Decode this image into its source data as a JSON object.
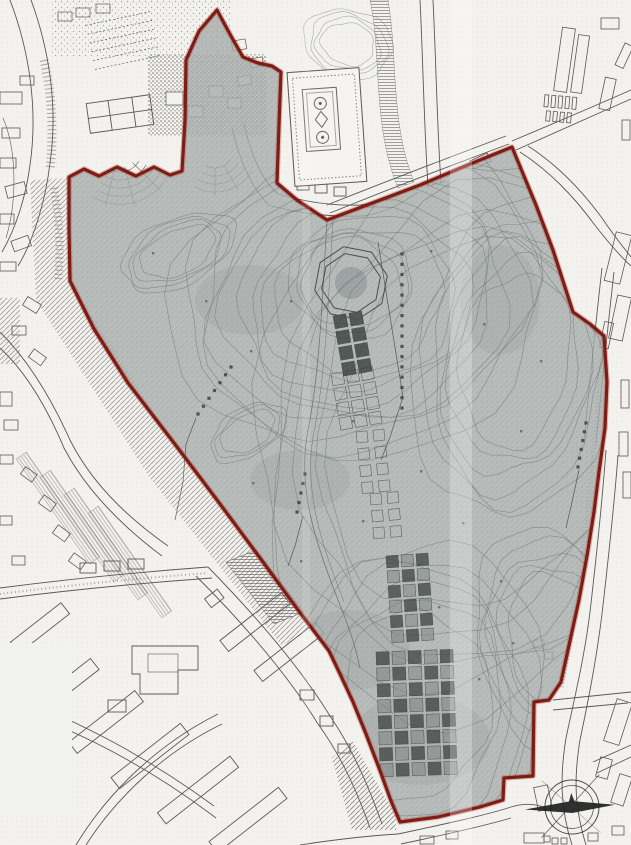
{
  "document": {
    "kind": "scanned site plan map",
    "visible_text": [],
    "notes": "monochrome scanned survey map with shaded study area outlined in dark red; annotation micro-text on map is illegible"
  },
  "map": {
    "palette": {
      "paper": "#f3f2ee",
      "ink": "#3f3e3c",
      "site_fill": "#a9aeac",
      "site_texture": "#7e8481",
      "contour": "#68706d",
      "boundary_red": "#7b150e",
      "boundary_red_soft": "#a03522",
      "structure_dark": "#3d4242",
      "structure_mid": "#7c8282",
      "needle_dark": "#1f1f1f"
    },
    "boundary": {
      "points": [
        [
          217,
          10
        ],
        [
          231,
          36
        ],
        [
          243,
          57
        ],
        [
          258,
          63
        ],
        [
          272,
          66
        ],
        [
          281,
          72
        ],
        [
          279,
          125
        ],
        [
          277,
          183
        ],
        [
          297,
          200
        ],
        [
          327,
          220
        ],
        [
          420,
          185
        ],
        [
          470,
          164
        ],
        [
          512,
          147
        ],
        [
          536,
          205
        ],
        [
          553,
          250
        ],
        [
          564,
          284
        ],
        [
          573,
          312
        ],
        [
          590,
          324
        ],
        [
          604,
          336
        ],
        [
          607,
          382
        ],
        [
          605,
          428
        ],
        [
          599,
          472
        ],
        [
          594,
          512
        ],
        [
          587,
          556
        ],
        [
          579,
          600
        ],
        [
          568,
          650
        ],
        [
          561,
          682
        ],
        [
          549,
          700
        ],
        [
          534,
          702
        ],
        [
          533,
          776
        ],
        [
          504,
          778
        ],
        [
          503,
          800
        ],
        [
          480,
          807
        ],
        [
          438,
          817
        ],
        [
          400,
          822
        ],
        [
          391,
          801
        ],
        [
          379,
          768
        ],
        [
          366,
          734
        ],
        [
          353,
          702
        ],
        [
          340,
          674
        ],
        [
          329,
          651
        ],
        [
          298,
          610
        ],
        [
          260,
          558
        ],
        [
          217,
          500
        ],
        [
          174,
          443
        ],
        [
          128,
          383
        ],
        [
          94,
          329
        ],
        [
          70,
          281
        ],
        [
          69,
          229
        ],
        [
          69,
          177
        ],
        [
          84,
          169
        ],
        [
          99,
          176
        ],
        [
          117,
          167
        ],
        [
          136,
          176
        ],
        [
          154,
          167
        ],
        [
          170,
          175
        ],
        [
          182,
          171
        ],
        [
          185,
          120
        ],
        [
          186,
          60
        ],
        [
          199,
          31
        ]
      ]
    },
    "octagon": {
      "cx": 351,
      "cy": 283,
      "radii": [
        37,
        30
      ],
      "rot": 11,
      "smudge_radius": 16
    },
    "grids": [
      {
        "name": "checker-upper",
        "x": 333,
        "y": 316,
        "cols": 2,
        "rows": 4,
        "cell": 13,
        "gap": 3,
        "rot": -10,
        "style": "dark"
      },
      {
        "name": "checker-upper-faint",
        "x": 331,
        "y": 374,
        "cols": 3,
        "rows": 4,
        "cell": 12,
        "gap": 3,
        "rot": -10,
        "style": "faint"
      },
      {
        "name": "checker-trail-a",
        "x": 356,
        "y": 432,
        "cols": 2,
        "rows": 4,
        "cell": 11,
        "gap": 6,
        "rot": -6,
        "style": "faint"
      },
      {
        "name": "checker-trail-b",
        "x": 370,
        "y": 494,
        "cols": 2,
        "rows": 3,
        "cell": 11,
        "gap": 6,
        "rot": -5,
        "style": "faint"
      },
      {
        "name": "checker-mid",
        "x": 386,
        "y": 556,
        "cols": 3,
        "rows": 6,
        "cell": 12,
        "gap": 3,
        "rot": -4,
        "style": "mixed"
      },
      {
        "name": "checker-lower",
        "x": 376,
        "y": 652,
        "cols": 5,
        "rows": 8,
        "cell": 13,
        "gap": 3,
        "rot": -2,
        "style": "mixed"
      }
    ],
    "contour_families": [
      {
        "cx": 360,
        "cy": 300,
        "rx": 85,
        "ry": 70,
        "rot": -15,
        "count": 9,
        "gap": 13,
        "clip": true
      },
      {
        "cx": 178,
        "cy": 252,
        "rx": 40,
        "ry": 22,
        "rot": -25,
        "count": 4,
        "gap": 7,
        "clip": true
      },
      {
        "cx": 515,
        "cy": 360,
        "rx": 55,
        "ry": 88,
        "rot": 8,
        "count": 6,
        "gap": 9,
        "clip": true
      },
      {
        "cx": 560,
        "cy": 645,
        "rx": 50,
        "ry": 72,
        "rot": -20,
        "count": 5,
        "gap": 8,
        "clip": true
      },
      {
        "cx": 415,
        "cy": 705,
        "rx": 75,
        "ry": 95,
        "rot": 4,
        "count": 6,
        "gap": 11,
        "clip": true
      },
      {
        "cx": 248,
        "cy": 432,
        "rx": 30,
        "ry": 17,
        "rot": -32,
        "count": 3,
        "gap": 6,
        "clip": true
      },
      {
        "cx": 351,
        "cy": 283,
        "rx": 50,
        "ry": 44,
        "rot": 10,
        "count": 3,
        "gap": 6,
        "clip": true
      },
      {
        "cx": 470,
        "cy": 430,
        "rx": 140,
        "ry": 185,
        "rot": 12,
        "count": 6,
        "gap": 15,
        "clip": true
      },
      {
        "cx": 348,
        "cy": 44,
        "rx": 27,
        "ry": 21,
        "rot": 15,
        "count": 4,
        "gap": 6,
        "clip": false
      }
    ],
    "blotches": [
      [
        350,
        650,
        60,
        40
      ],
      [
        420,
        740,
        70,
        45
      ],
      [
        250,
        300,
        55,
        35
      ],
      [
        500,
        300,
        40,
        55
      ],
      [
        300,
        480,
        50,
        30
      ]
    ],
    "annotations": [
      {
        "leader": [
          [
            378,
            242
          ],
          [
            403,
            397
          ],
          [
            390,
            437
          ],
          [
            381,
            460
          ]
        ],
        "ticks": {
          "x1": 402,
          "y1": 254,
          "x2": 402,
          "y2": 408,
          "n": 16
        }
      },
      {
        "leader": [
          [
            196,
            418
          ],
          [
            186,
            444
          ],
          [
            183,
            482
          ],
          [
            175,
            520
          ]
        ],
        "ticks": {
          "x1": 231,
          "y1": 367,
          "x2": 198,
          "y2": 414,
          "n": 7
        }
      },
      {
        "leader": [
          [
            303,
            516
          ],
          [
            295,
            546
          ],
          [
            288,
            566
          ]
        ],
        "ticks": {
          "x1": 305,
          "y1": 474,
          "x2": 297,
          "y2": 512,
          "n": 5
        }
      },
      {
        "leader": [
          [
            579,
            470
          ],
          [
            572,
            502
          ],
          [
            566,
            528
          ]
        ],
        "ticks": {
          "x1": 586,
          "y1": 423,
          "x2": 578,
          "y2": 467,
          "n": 6
        }
      }
    ],
    "spots": [
      [
        250,
        350
      ],
      [
        290,
        300
      ],
      [
        430,
        250
      ],
      [
        483,
        323
      ],
      [
        520,
        430
      ],
      [
        462,
        522
      ],
      [
        300,
        560
      ],
      [
        252,
        482
      ],
      [
        500,
        580
      ],
      [
        420,
        470
      ],
      [
        362,
        520
      ],
      [
        540,
        360
      ],
      [
        205,
        300
      ],
      [
        152,
        252
      ],
      [
        478,
        678
      ],
      [
        352,
        420
      ],
      [
        438,
        606
      ],
      [
        512,
        642
      ]
    ],
    "compass": {
      "cx": 572,
      "cy": 807,
      "r_outer": 27,
      "r_inner": 21.5,
      "rot": -3,
      "west_len": 47,
      "east_len": 43,
      "half_width": 6,
      "spike": 14
    },
    "streaks": [
      {
        "x": 450,
        "w": 22,
        "opacity": 0.26
      },
      {
        "x": 302,
        "w": 8,
        "opacity": 0.12
      }
    ]
  }
}
